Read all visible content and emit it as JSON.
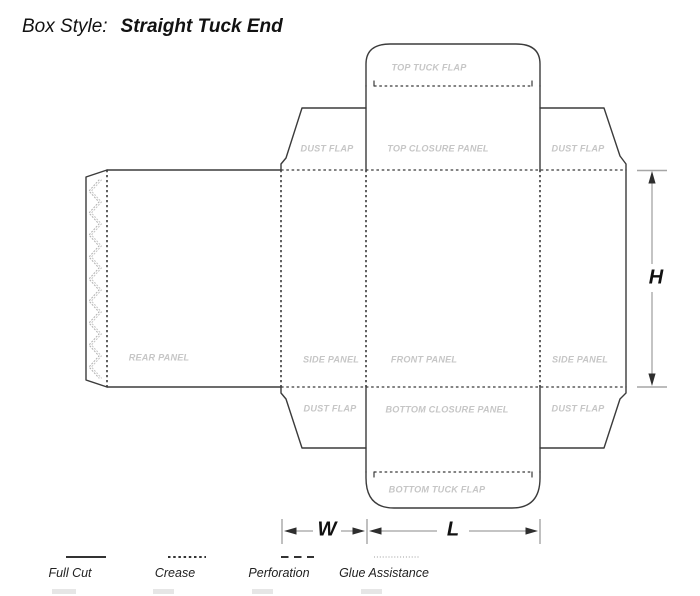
{
  "header": {
    "prefix": "Box Style:",
    "title": "Straight Tuck End"
  },
  "panels": {
    "top_tuck_flap": "TOP TUCK FLAP",
    "dust_flap_top_left": "DUST FLAP",
    "top_closure_panel": "TOP CLOSURE PANEL",
    "dust_flap_top_right": "DUST FLAP",
    "rear_panel": "REAR PANEL",
    "side_panel_left": "SIDE PANEL",
    "front_panel": "FRONT PANEL",
    "side_panel_right": "SIDE PANEL",
    "dust_flap_bottom_left": "DUST FLAP",
    "bottom_closure_panel": "BOTTOM CLOSURE PANEL",
    "dust_flap_bottom_right": "DUST FLAP",
    "bottom_tuck_flap": "BOTTOM TUCK FLAP"
  },
  "dimensions": {
    "height": "H",
    "width": "W",
    "length": "L"
  },
  "legend": [
    {
      "label": "Full Cut",
      "line_style": "solid"
    },
    {
      "label": "Crease",
      "line_style": "dotted"
    },
    {
      "label": "Perforation",
      "line_style": "dashed"
    },
    {
      "label": "Glue Assistance",
      "line_style": "fine-dotted"
    }
  ],
  "colors": {
    "diecut_line": "#3b3b3b",
    "panel_label": "#c6c6c6",
    "dimension_text": "#111111",
    "dimension_tick": "#a6a6a6",
    "glue_dots": "#b4b4b4",
    "background": "#ffffff"
  }
}
